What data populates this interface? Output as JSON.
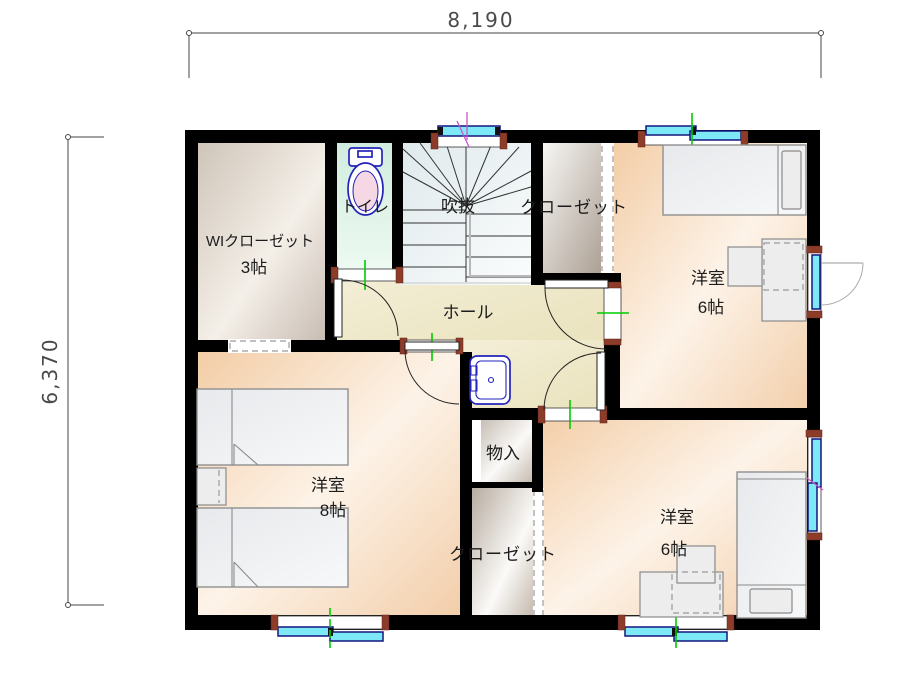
{
  "plan": {
    "title": "2F間取り図",
    "dimensions": {
      "width_mm": "8,190",
      "height_mm": "6,370"
    },
    "rooms": {
      "wic": {
        "name": "WIクローゼット",
        "size": "3帖"
      },
      "toilet": {
        "name": "トイレ"
      },
      "stair_void": {
        "name": "吹抜"
      },
      "closet_north": {
        "name": "クローゼット"
      },
      "bedroom_ne": {
        "name": "洋室",
        "size": "6帖"
      },
      "hall": {
        "name": "ホール"
      },
      "storage": {
        "name": "物入"
      },
      "bedroom_west": {
        "name": "洋室",
        "size": "8帖"
      },
      "closet_south": {
        "name": "クローゼット"
      },
      "bedroom_se": {
        "name": "洋室",
        "size": "6帖"
      }
    },
    "colors": {
      "wall": "#000000",
      "window_glass": "#7de9f7",
      "window_frame": "#15157e",
      "frame_cap": "#8e3c2a",
      "center_tick": "#00cc00",
      "accent_mark": "#cc55cc",
      "fixture_outline": "#2323bb",
      "floor_bedroom": "#f5d1ae",
      "floor_hall": "#efe8cc",
      "floor_toilet": "#cfeadd",
      "floor_closet": "#b5a99c",
      "floor_stairs": "#dde7ea"
    }
  }
}
